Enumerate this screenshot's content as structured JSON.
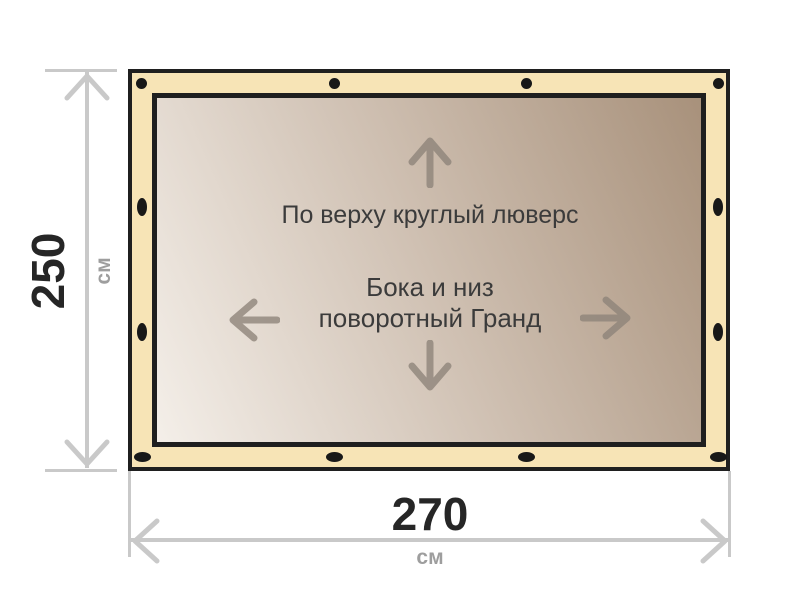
{
  "banner": {
    "annotations": {
      "top_edge": "По верху круглый люверс",
      "sides_line1": "Бока и низ",
      "sides_line2": "поворотный Гранд"
    }
  },
  "dimensions": {
    "height": {
      "value": "250",
      "unit": "см"
    },
    "width": {
      "value": "270",
      "unit": "см"
    }
  },
  "colors": {
    "page_bg": "#ffffff",
    "fabric_edge": "#f7e4b6",
    "fabric_light": "#f4efe9",
    "fabric_dark": "#a8917b",
    "outline": "#1f1f1f",
    "grommet": "#181818",
    "dimension_line": "#c9c9c9",
    "dimension_number": "#262626",
    "dimension_unit": "#9e9e9e",
    "annotation_text": "#3b3b3b",
    "direction_arrow": "#8d8379"
  },
  "icons": {
    "inner_arrows": [
      "arrow-up-icon",
      "arrow-left-icon",
      "arrow-right-icon",
      "arrow-down-icon"
    ],
    "dimension_arrows": [
      "dim-arrow-up-icon",
      "dim-arrow-down-icon",
      "dim-arrow-left-icon",
      "dim-arrow-right-icon"
    ]
  }
}
